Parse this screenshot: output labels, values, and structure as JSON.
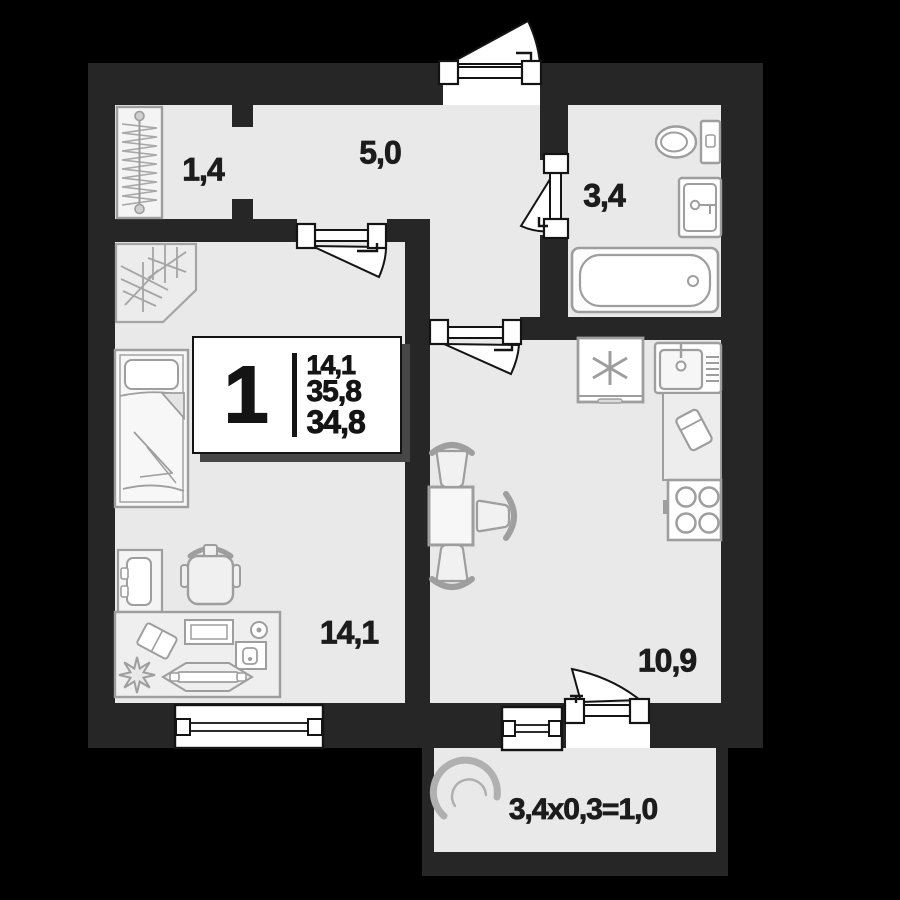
{
  "plan": {
    "type": "apartment-floor-plan",
    "rooms": [
      {
        "id": "storage",
        "label": "1,4"
      },
      {
        "id": "hallway",
        "label": "5,0"
      },
      {
        "id": "bathroom",
        "label": "3,4"
      },
      {
        "id": "living-room",
        "label": "14,1"
      },
      {
        "id": "kitchen",
        "label": "10,9"
      },
      {
        "id": "balcony",
        "label": "3,4x0,3=1,0"
      }
    ],
    "info_card": {
      "room_count": "1",
      "areas": [
        "14,1",
        "35,8",
        "34,8"
      ]
    },
    "colors": {
      "background": "#000000",
      "wall": "#262626",
      "floor": "#e9e9e9",
      "fixture_stroke": "#9e9e9e",
      "symbol_stroke": "#141414",
      "card_shadow": "#474747",
      "text": "#1c1c1c"
    },
    "icons": [
      "wardrobe-icon",
      "coat-rack-icon",
      "bed-icon",
      "nightstand-icon",
      "office-chair-icon",
      "desk-icon",
      "fridge-icon",
      "kitchen-sink-icon",
      "cutting-board-icon",
      "stove-icon",
      "dining-table-icon",
      "chair-icon",
      "toilet-icon",
      "washbasin-icon",
      "bathtub-icon",
      "balcony-chair-icon",
      "door-icon",
      "window-icon"
    ]
  }
}
